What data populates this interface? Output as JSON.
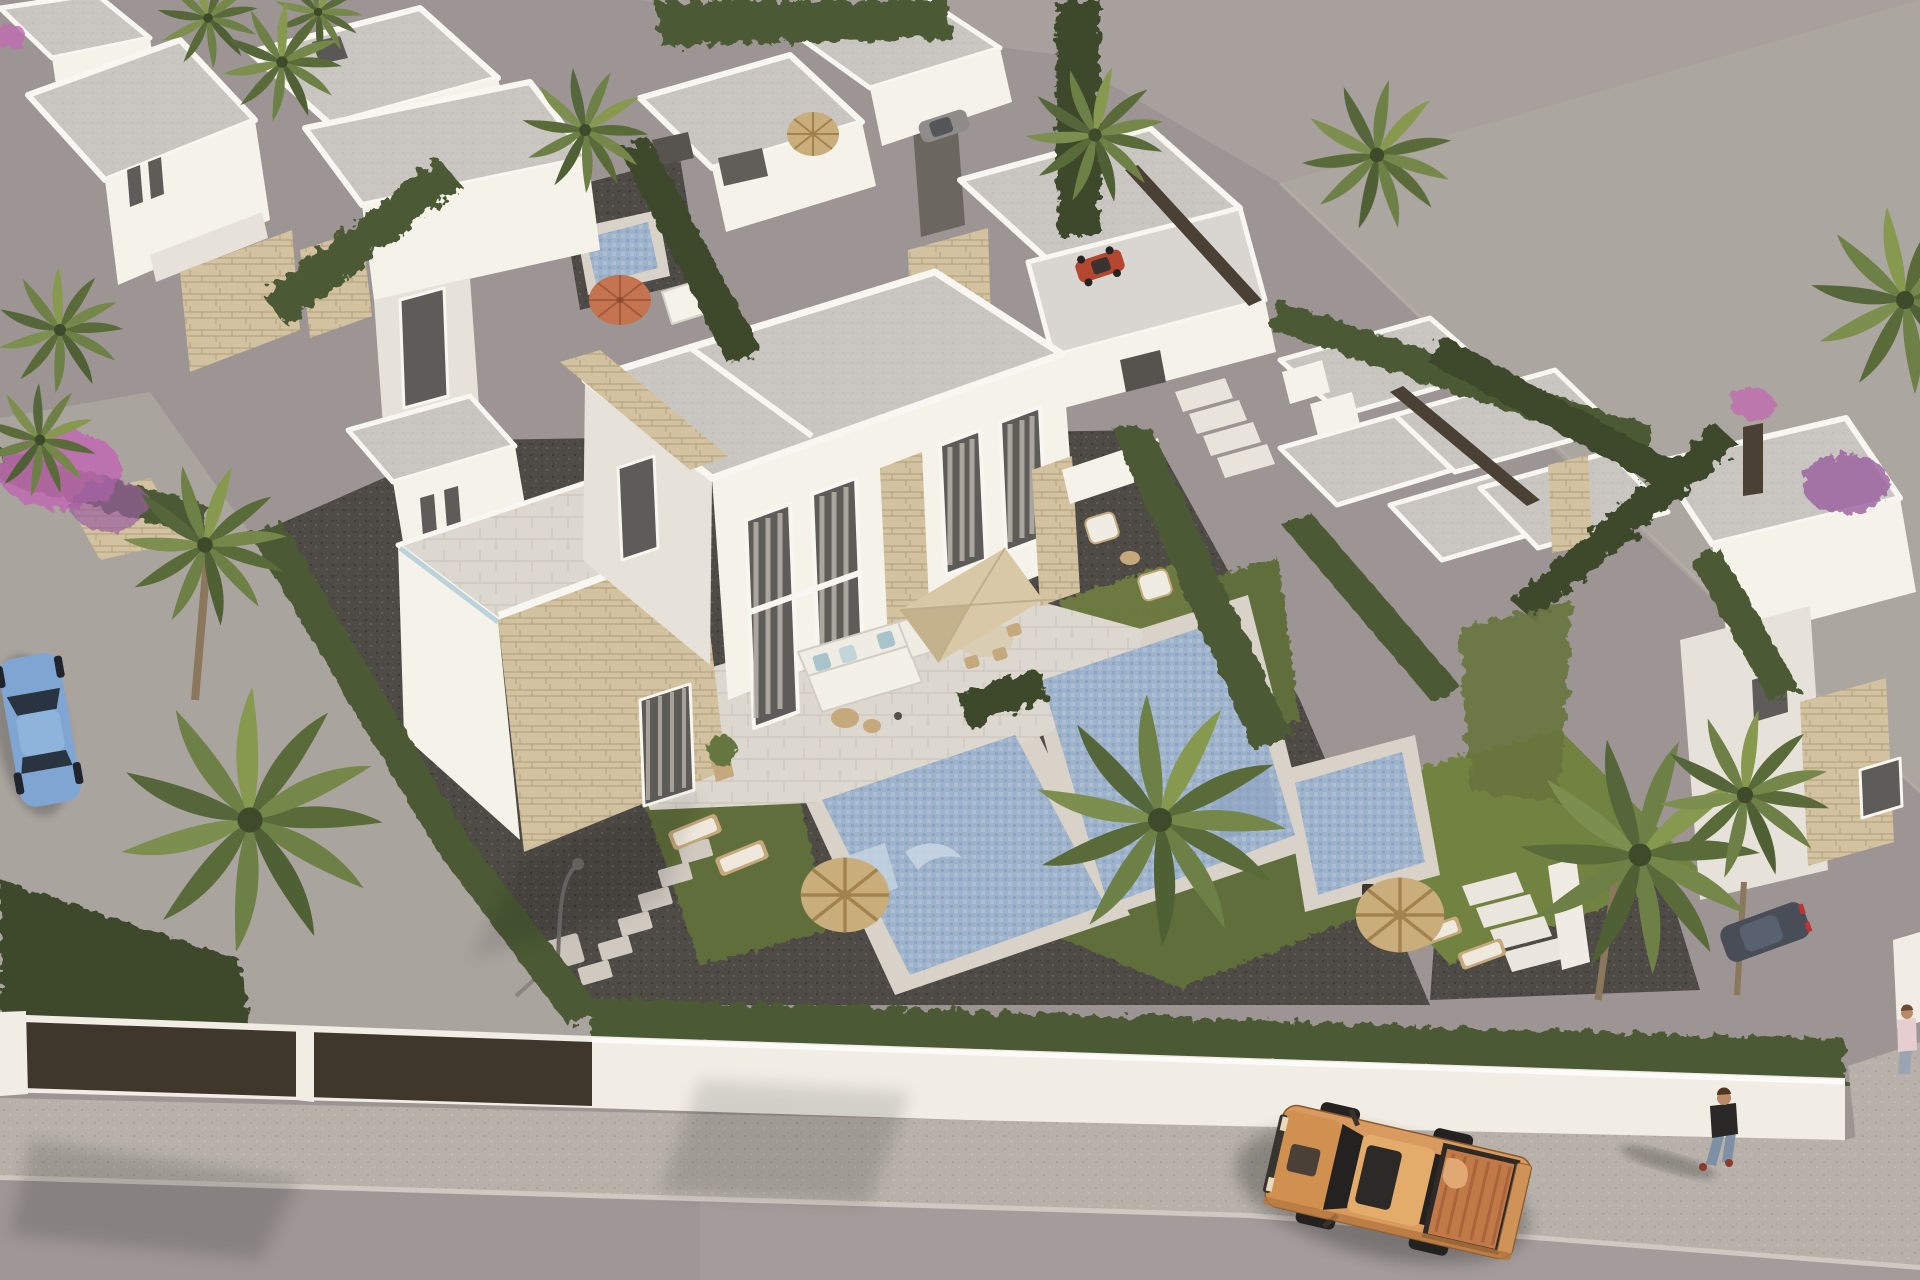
{
  "meta": {
    "image_type": "architectural-aerial-render",
    "description": "Bird's-eye 3D rendering of a modern white villa development with private pools, palm trees, hedges, a street with an orange pickup truck and pedestrians"
  },
  "palette": {
    "groundBase": "#9c9594",
    "groundEmpty": "#a7a09c",
    "groundEmptyLight": "#b2aba6",
    "pavementLeft": "#aaa49f",
    "road": "#a39c9a",
    "roadDark": "#968f8d",
    "sidewalk": "#b7b1aa",
    "curb": "#cfc9c1",
    "wallWhite": "#f1ede5",
    "wallShade": "#ddd8cf",
    "gatePanel": "#40372c",
    "roofGray": "#c9c6c2",
    "roofLight": "#d9d6d2",
    "white": "#f5f2ea",
    "whiteShade": "#e6e2d9",
    "whiteDark": "#d3cec5",
    "stone": "#d3c2a0",
    "stoneLine": "#b7a480",
    "glass": "#5d5c58",
    "curtain": "#b9b3aa",
    "frame": "#f8f6f0",
    "hedge": "#4c5a36",
    "hedgeLight": "#66763f",
    "hedgeDark": "#3c482b",
    "lawn": "#5f6e3a",
    "lawnLight": "#72823f",
    "gravel": "#4e4a46",
    "gravelLight": "#6b6660",
    "poolWater": "#9db2cb",
    "poolLight": "#c6d4e2",
    "poolDeep": "#8aa2bf",
    "deck": "#d8d2c8",
    "tile": "#dcd7cf",
    "tileLine": "#c7c1b7",
    "straw": "#c9ad7a",
    "strawDark": "#a2834f",
    "parasol": "#d9c8a5",
    "parasolShade": "#c4b28d",
    "orangeUmb": "#c4744f",
    "sofa": "#efece4",
    "cushionBlue": "#a9c3cb",
    "woodTan": "#c5a87c",
    "truckBody": "#d89a5e",
    "truckHood": "#cf9050",
    "truckRoof": "#e3ac6b",
    "truckBed": "#c07947",
    "truckBedRib": "#a8643a",
    "truckDark": "#242220",
    "cargo": "#e0a873",
    "carBlue": "#7fa6d2",
    "carBlueDark": "#2a3340",
    "carGray": "#908c89",
    "carDark": "#484d58",
    "quadRed": "#b5462f",
    "skin": "#bb8a66",
    "shirtDark": "#2b2927",
    "jeans": "#7e90a6",
    "shoe": "#8a3b2a",
    "pink": "#c06ab0",
    "purple": "#9a5f9e",
    "trunk": "#8a775c",
    "lampMetal": "#6f6e6b",
    "fenceBrown": "#4a4034"
  },
  "scene": {
    "objects": [
      "white-flat-roof-villas",
      "semi-detached-featured-villa",
      "swimming-pools",
      "garden-lawns",
      "cypress-hedges",
      "palm-trees",
      "straw-sun-umbrellas",
      "orange-sun-umbrella",
      "sun-loungers",
      "outdoor-corner-sofa",
      "terrace-parasol-dining",
      "armchair-set",
      "street-lamp",
      "stepping-stones",
      "garden-stairs",
      "perimeter-white-wall",
      "dark-entrance-gates",
      "sidewalk",
      "street",
      "orange-pickup-truck",
      "walking-pedestrians",
      "parked-blue-car",
      "parked-gray-car",
      "parked-dark-car",
      "red-quad-bike",
      "bougainvillea-flowers",
      "empty-building-plot"
    ]
  }
}
